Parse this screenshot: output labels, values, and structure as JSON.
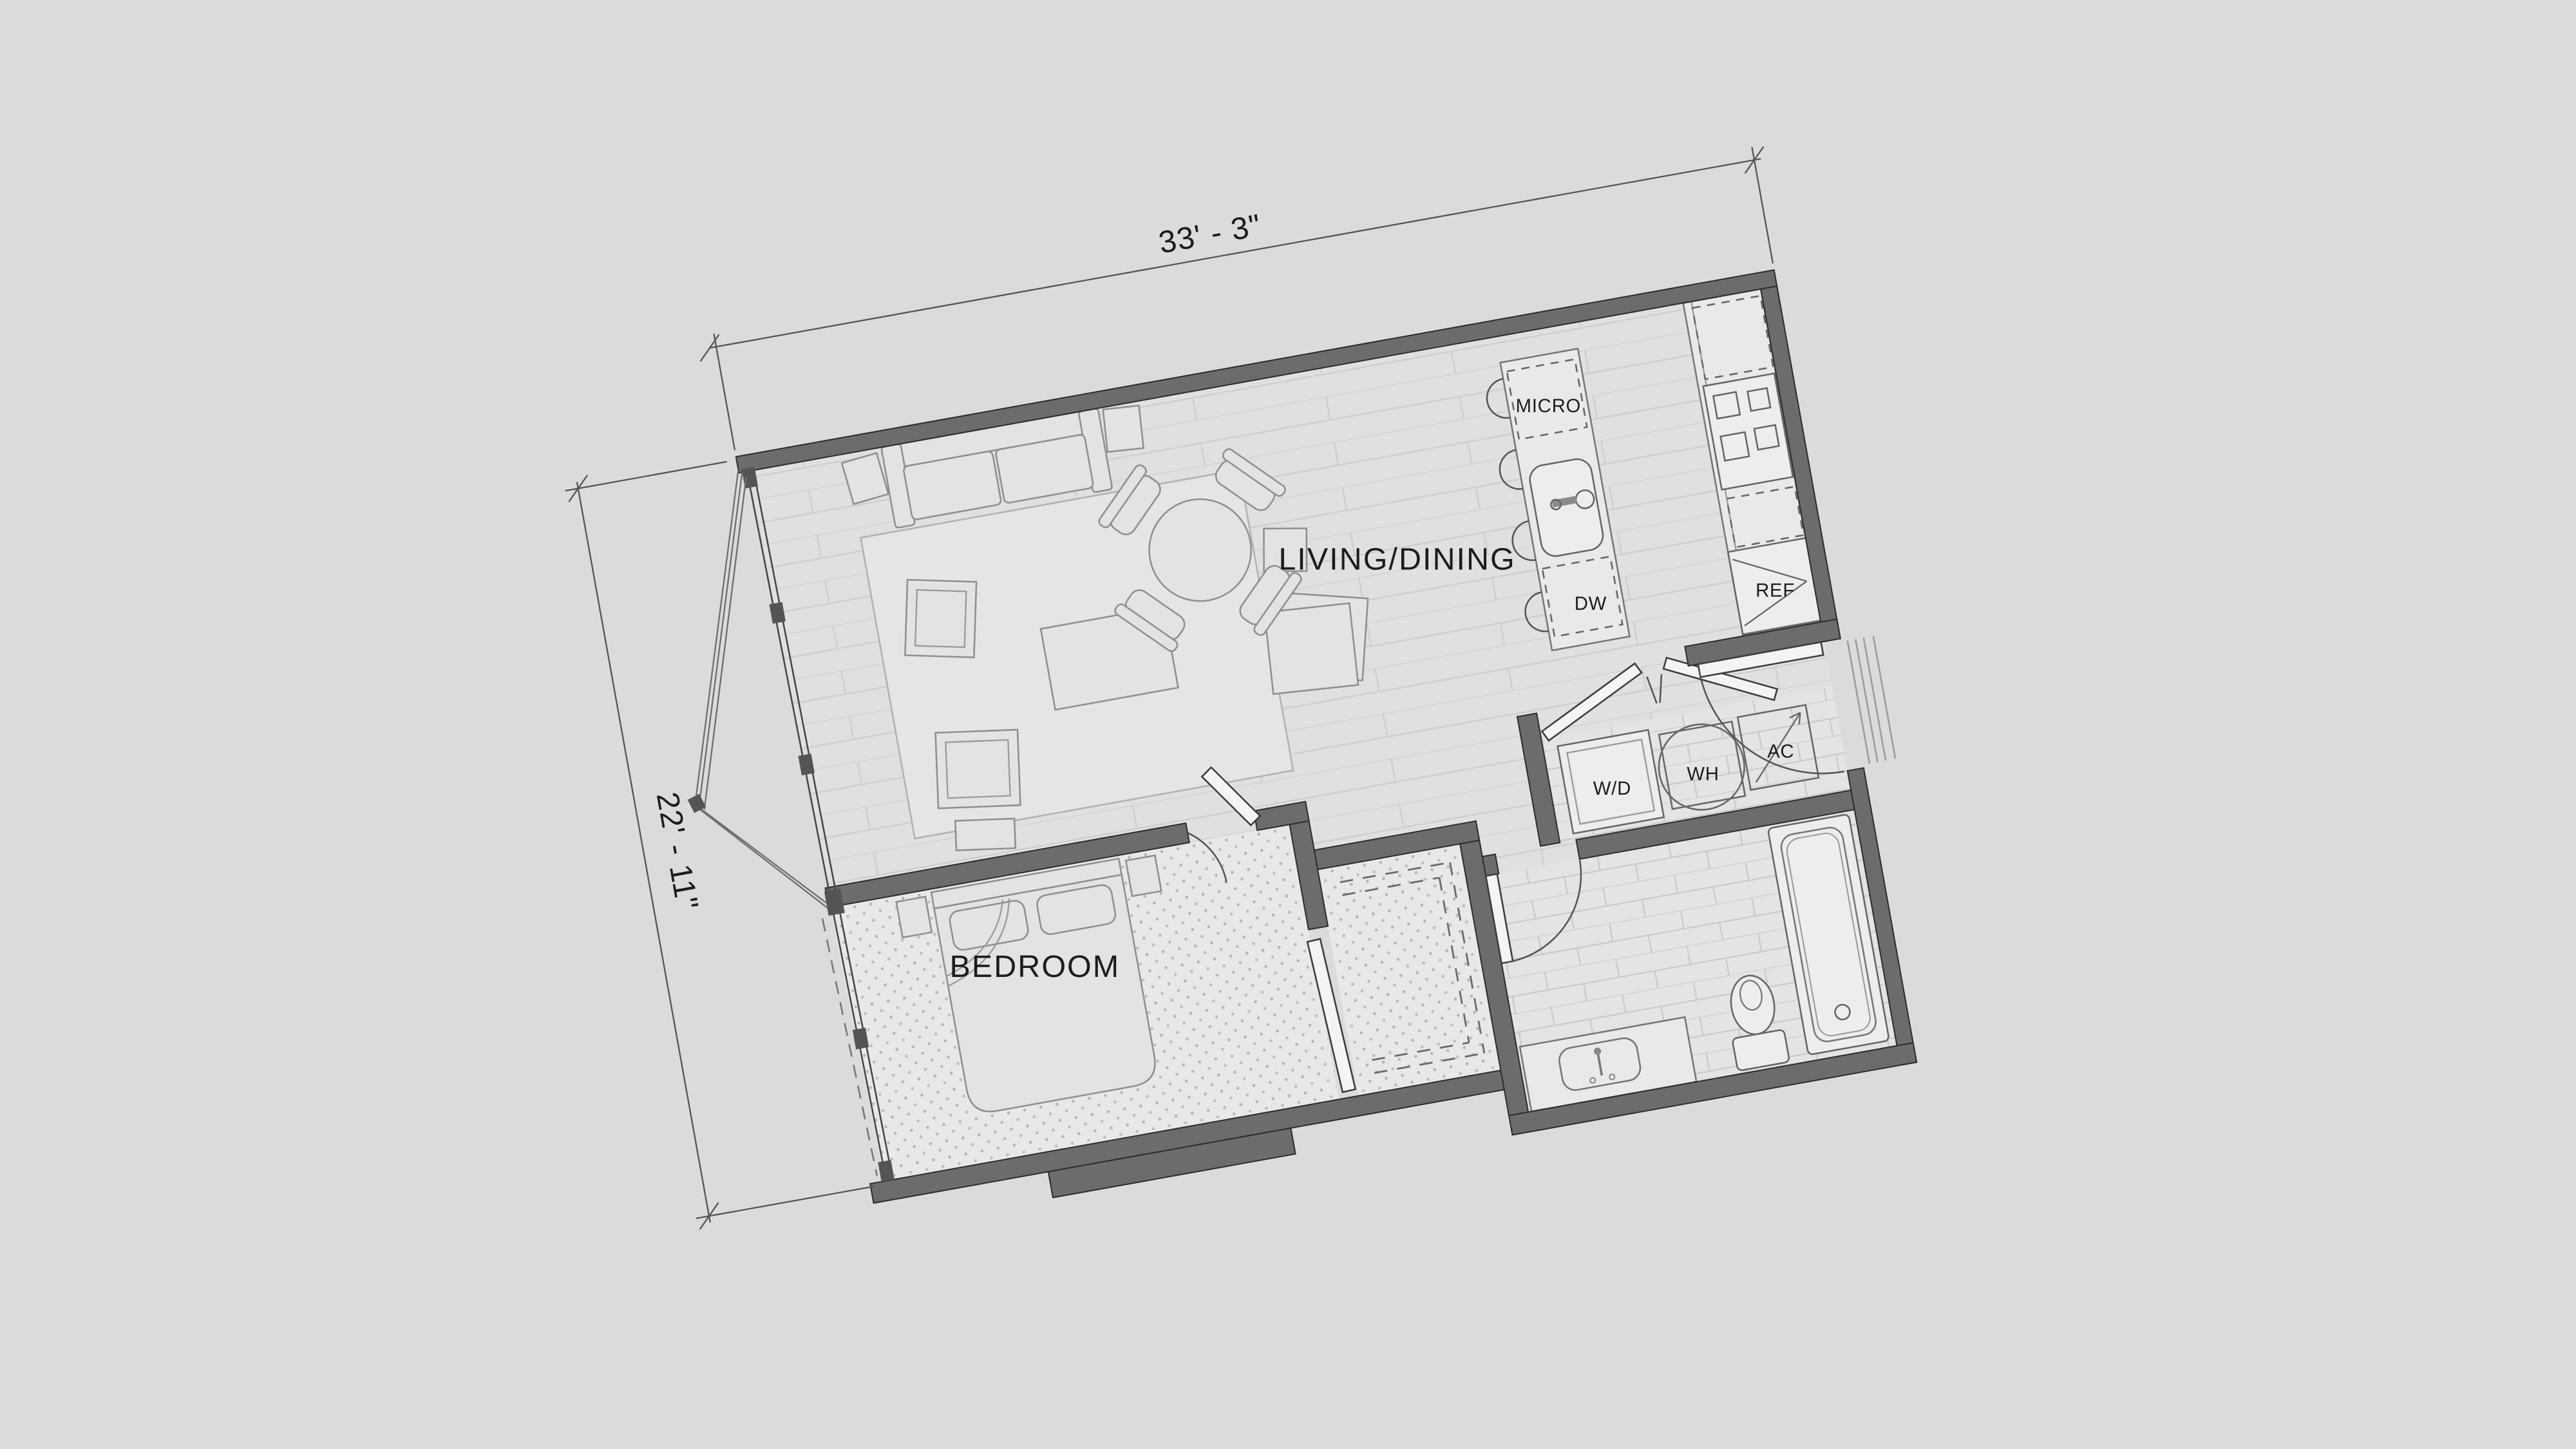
{
  "labels": {
    "living_dining": "LIVING/DINING",
    "bedroom": "BEDROOM",
    "micro": "MICRO",
    "dw": "DW",
    "ref": "REF",
    "wd": "W/D",
    "wh": "WH",
    "ac": "AC"
  },
  "dimensions": {
    "width": "33' - 3\"",
    "depth": "22' - 11\""
  },
  "colors": {
    "background": "#dbdbdb",
    "wall": "#6c6c6c",
    "floor": "#e0e0e0",
    "plank_line": "#cccccc",
    "carpet_dot": "#b5b5b5",
    "tile_line": "#c8c8c8",
    "outline": "#8f8f8f",
    "text": "#1c1c1c"
  }
}
